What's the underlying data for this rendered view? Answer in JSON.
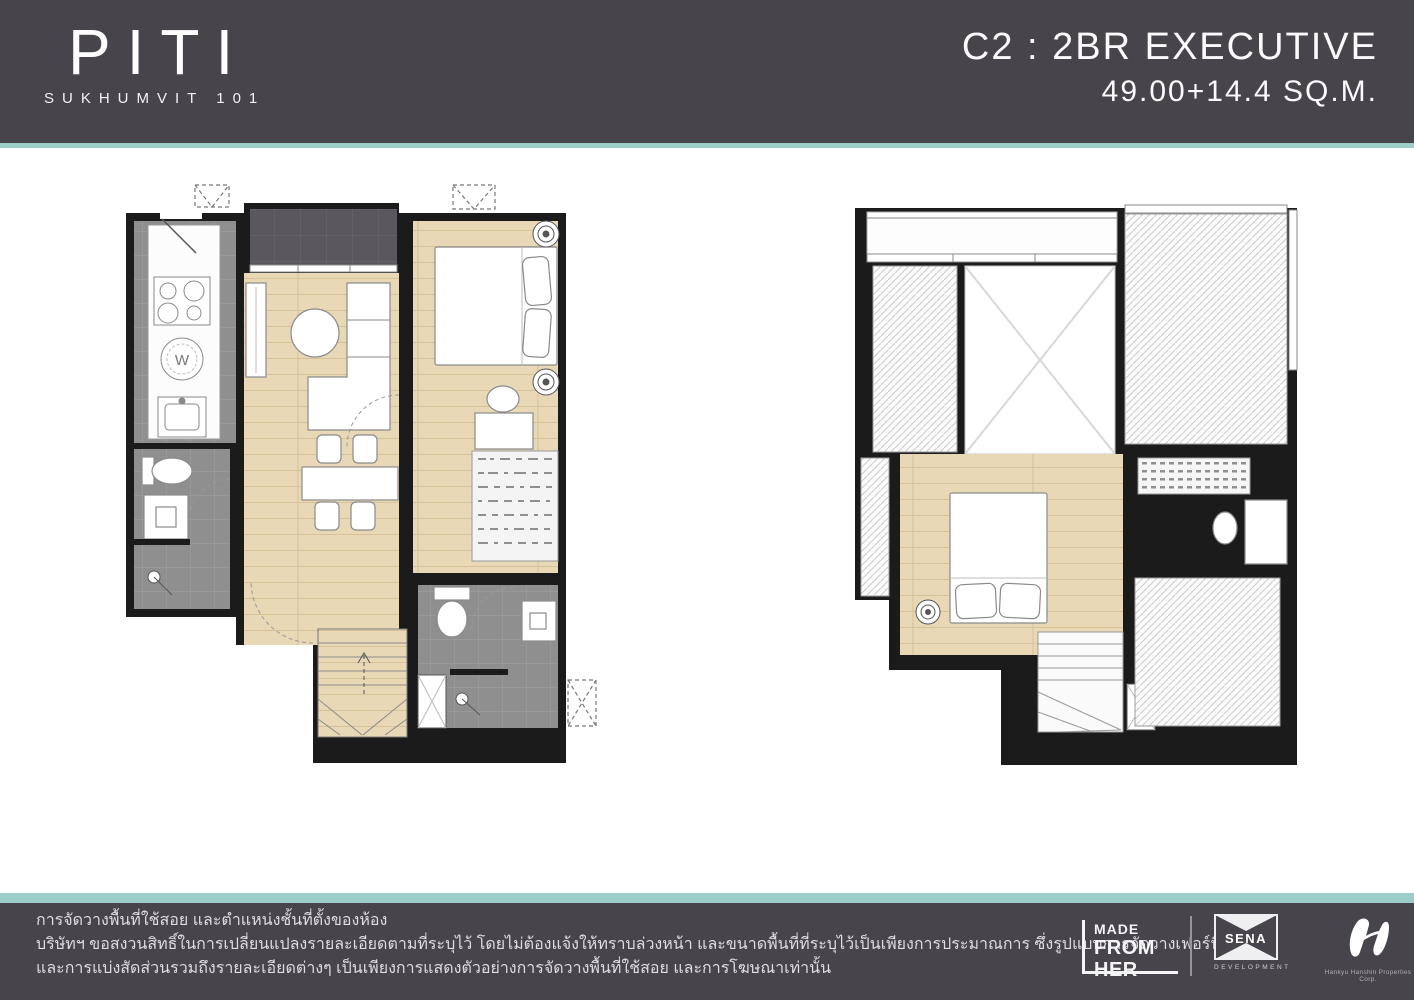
{
  "header": {
    "brand_name": "PITI",
    "brand_subtitle": "SUKHUMVIT 101",
    "unit_code_title": "C2 : 2BR EXECUTIVE",
    "unit_area": "49.00+14.4 SQ.M."
  },
  "plans": {
    "washer_label": "W"
  },
  "footer": {
    "disclaimer_line1": "การจัดวางพื้นที่ใช้สอย และตำแหน่งชั้นที่ตั้งของห้อง",
    "disclaimer_line2": "บริษัทฯ ขอสงวนสิทธิ์ในการเปลี่ยนแปลงรายละเอียดตามที่ระบุไว้ โดยไม่ต้องแจ้งให้ทราบล่วงหน้า และขนาดพื้นที่ที่ระบุไว้เป็นเพียงการประมาณการ ซึ่งรูปแบบการจัดวางเฟอร์นิเจอร์",
    "disclaimer_line3": "และการแบ่งสัดส่วนรวมถึงรายละเอียดต่างๆ เป็นเพียงการแสดงตัวอย่างการจัดวางพื้นที่ใช้สอย และการโฆษณาเท่านั้น",
    "logo_made_from_her_line1": "MADE",
    "logo_made_from_her_line2": "FROM HER",
    "logo_sena_name": "SENA",
    "logo_sena_subtitle": "DEVELOPMENT",
    "logo_hankyu_caption": "Hankyu Hanshin Properties Corp."
  },
  "colors": {
    "header_footer_background": "#48444b",
    "accent_teal": "#9bcdc9",
    "wall_black": "#1b1b1b",
    "wood_floor": "#e9d8b6",
    "tile_gray": "#8f8f8f",
    "balcony_dark_tile": "#5a575e",
    "text_white": "#ffffff"
  }
}
